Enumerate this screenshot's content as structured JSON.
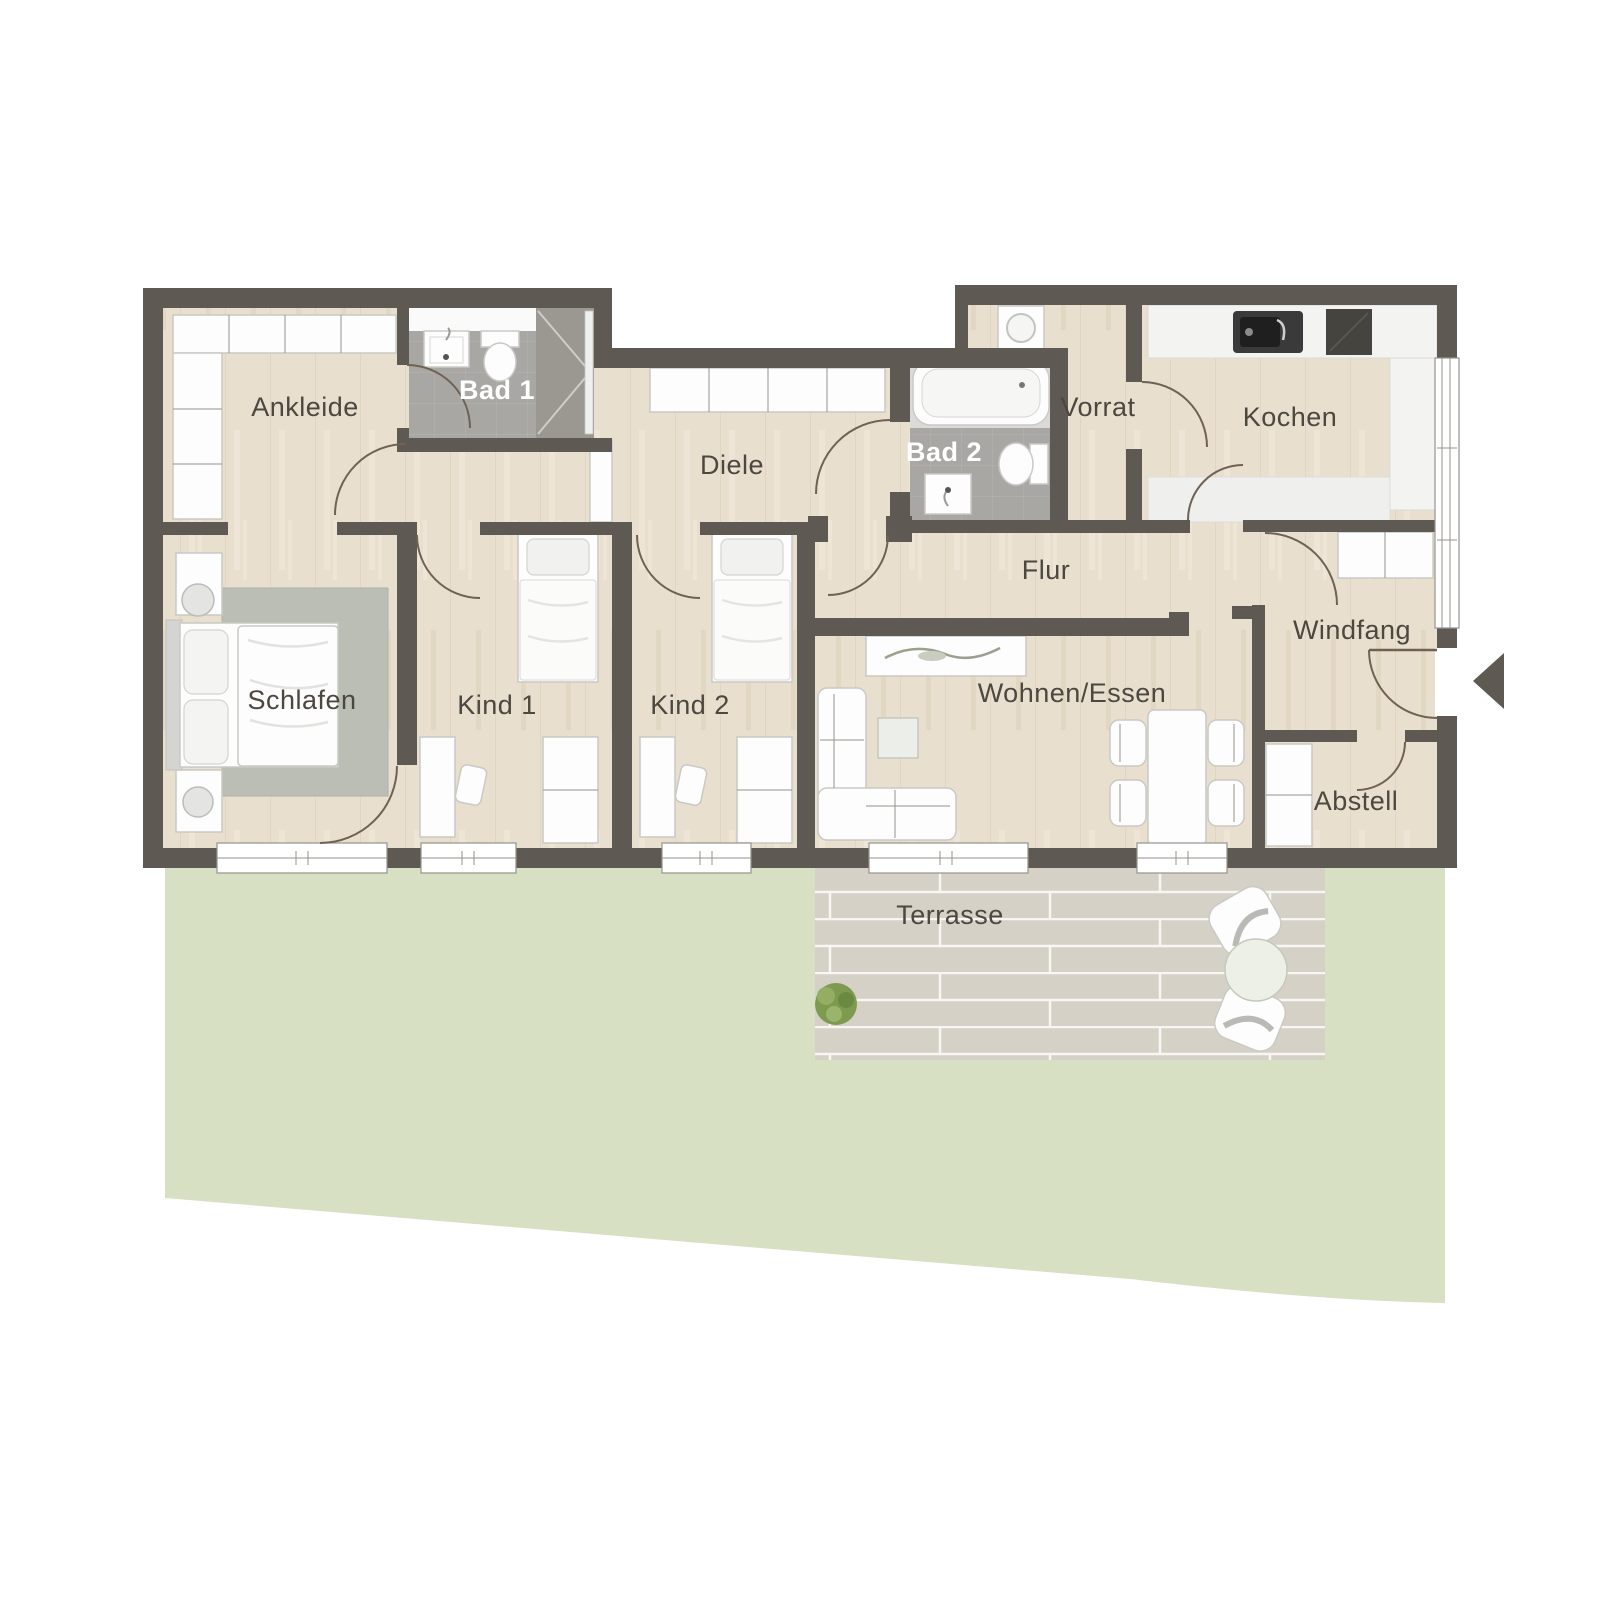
{
  "plan": {
    "title": "Bungalow Grundriss",
    "rooms": {
      "ankleide": {
        "label": "Ankleide"
      },
      "bad1": {
        "label": "Bad 1"
      },
      "schlafen": {
        "label": "Schlafen"
      },
      "kind1": {
        "label": "Kind 1"
      },
      "kind2": {
        "label": "Kind 2"
      },
      "diele": {
        "label": "Diele"
      },
      "bad2": {
        "label": "Bad 2"
      },
      "vorrat": {
        "label": "Vorrat"
      },
      "kochen": {
        "label": "Kochen"
      },
      "flur": {
        "label": "Flur"
      },
      "wohnen_essen": {
        "label": "Wohnen/Essen"
      },
      "windfang": {
        "label": "Windfang"
      },
      "abstell": {
        "label": "Abstell"
      },
      "terrasse": {
        "label": "Terrasse"
      }
    },
    "entrance": {
      "side": "right",
      "marker": "arrow-left"
    },
    "colors": {
      "wall": "#5e5952",
      "wood_floor": "#e9dfcf",
      "tile": "#a9a7a3",
      "tile_dark": "#9b9892",
      "garden": "#d7e0c3",
      "terrace_paving": "#d5d1c7",
      "furniture": "#fdfdfd",
      "rug": "#babeb4",
      "label_text": "#4c473f",
      "label_text_light": "#ffffff",
      "door_arc": "#6f6255"
    }
  }
}
